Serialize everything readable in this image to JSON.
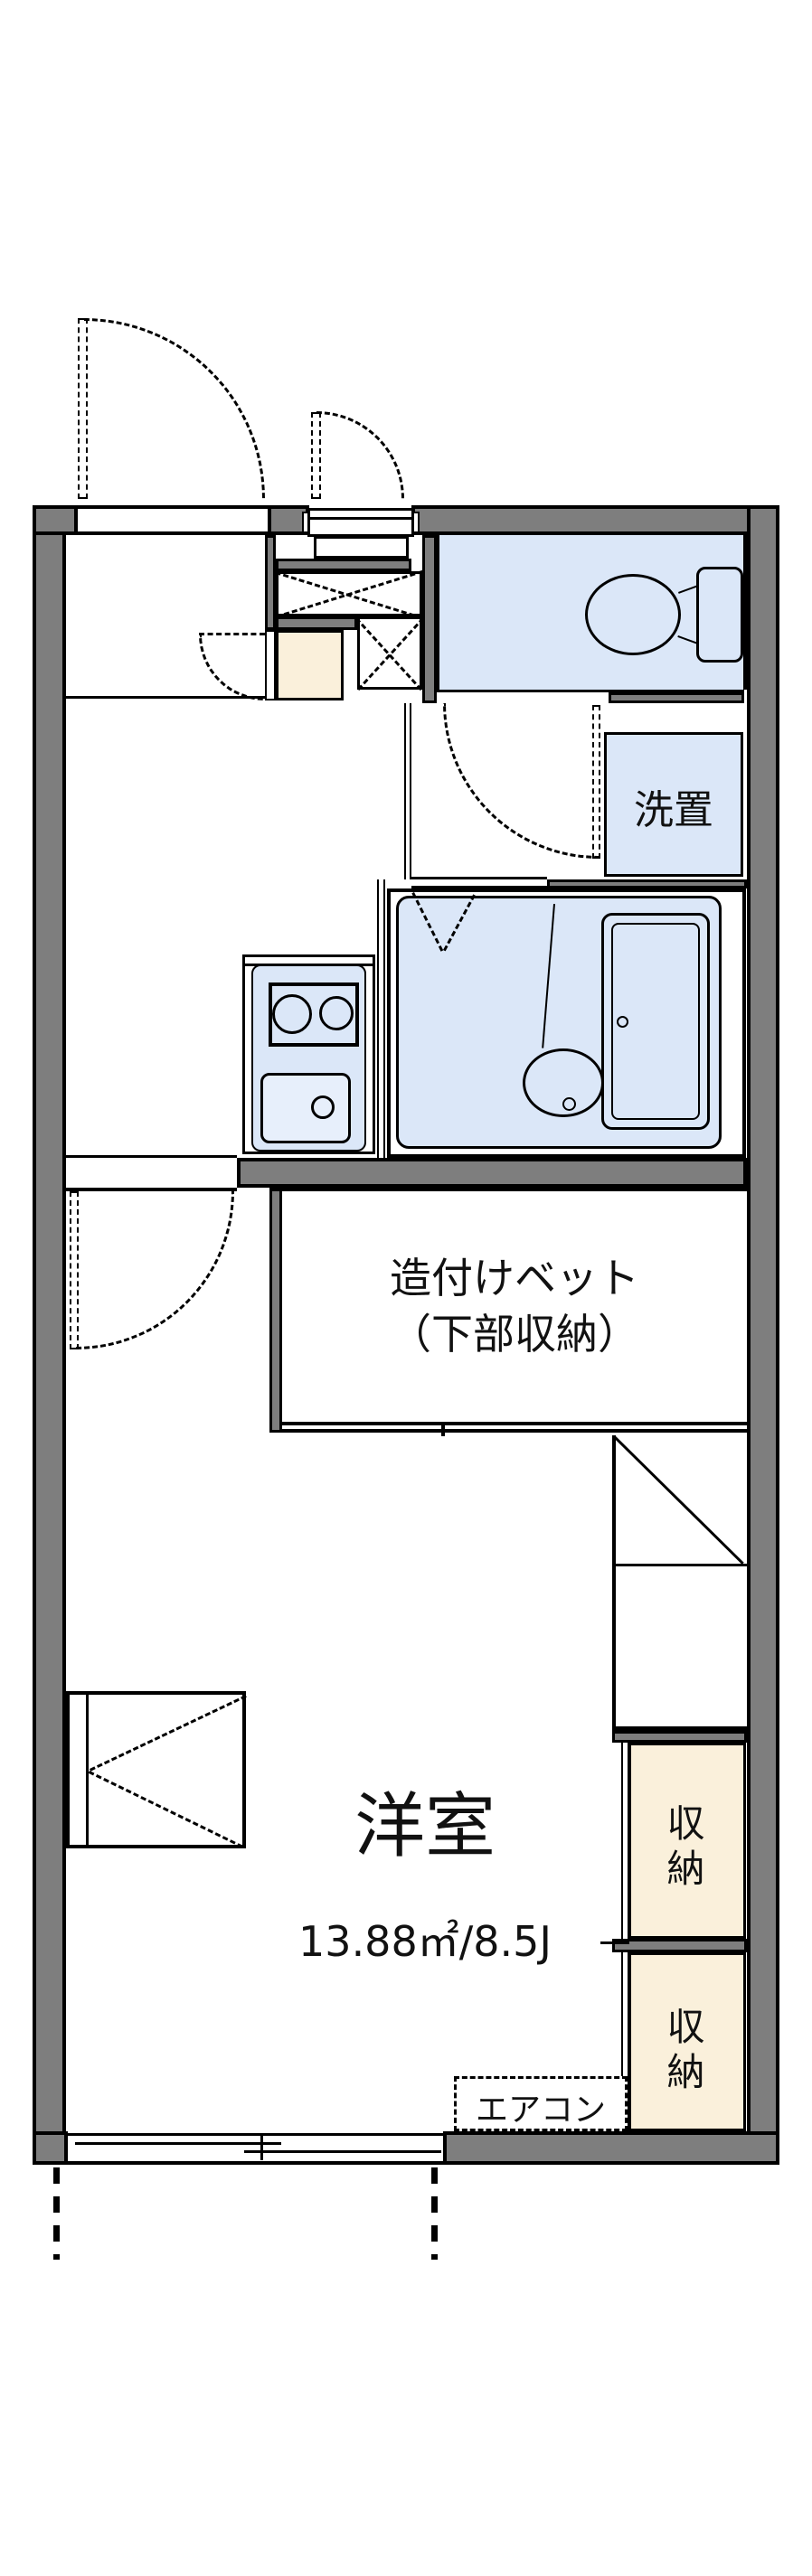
{
  "plan": {
    "bed": {
      "line1": "造付けベット",
      "line2": "（下部収納）"
    },
    "main_room": {
      "name": "洋室",
      "size": "13.88㎡/8.5J"
    },
    "washer_label": "洗置",
    "closet_upper_label": "収納",
    "closet_lower_label": "収納",
    "aircon_label": "エアコン",
    "colors": {
      "wall": "#7e7e7e",
      "fixture": "#dbe7f8",
      "storage": "#faf0db",
      "line": "#000000"
    }
  }
}
